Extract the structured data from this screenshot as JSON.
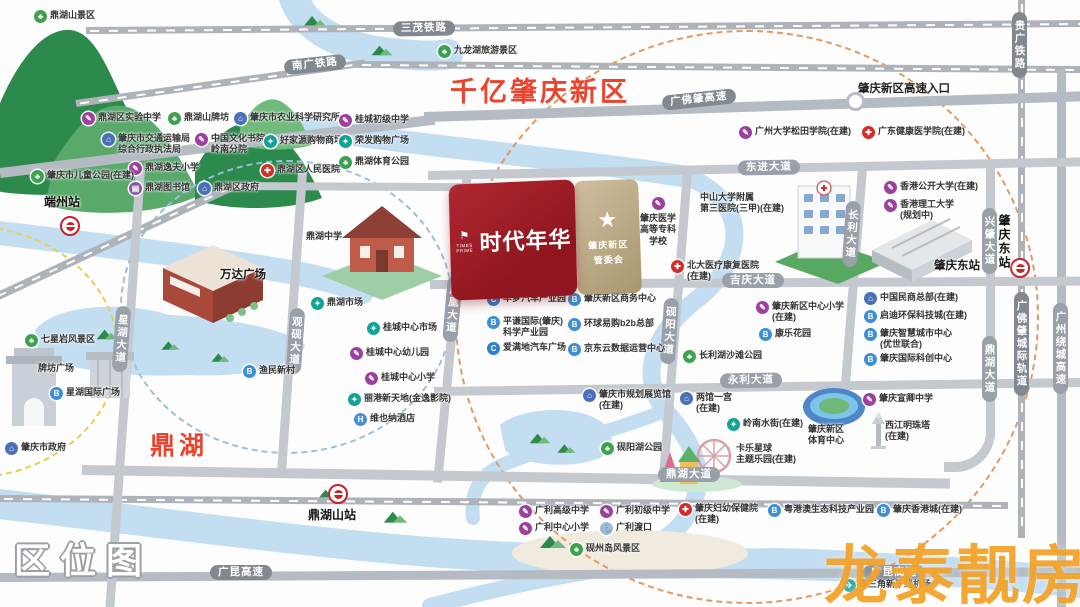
{
  "texts": {
    "qianyi": "千亿肇庆新区",
    "dinghu_area": "鼎湖",
    "quweitu": "区位图",
    "entrance": "肇庆新区高速入口"
  },
  "property": {
    "name": "时代年华",
    "logo_en": "TIMES PRIME",
    "star_icon": "★",
    "committee_lines": [
      "肇庆新区",
      "管委会"
    ]
  },
  "watermark": {
    "text": "龙泰靓房"
  },
  "map": {
    "icon_glyphs": {
      "park": "♣",
      "school": "✎",
      "gov": "⌂",
      "shop": "✦",
      "hospital": "✚",
      "library": "▤",
      "business": "B",
      "hotel": "H",
      "car": "C",
      "ferry": "⚓",
      "airport": "✈"
    },
    "roads": [
      {
        "id": "sanmao-railway",
        "kind": "rail",
        "vert": false,
        "x": 86,
        "y": 27,
        "len": 1000,
        "thick": 7,
        "angle": -0.4
      },
      {
        "id": "nanguang-railway-west",
        "kind": "rail",
        "vert": false,
        "x": 76,
        "y": 100,
        "len": 292,
        "thick": 7,
        "angle": -8
      },
      {
        "id": "nanguang-railway",
        "kind": "rail",
        "vert": false,
        "x": 358,
        "y": 61,
        "len": 724,
        "thick": 7,
        "angle": 0.4
      },
      {
        "id": "duanzhou-railway",
        "kind": "rail",
        "vert": false,
        "x": -6,
        "y": 294,
        "len": 262,
        "thick": 8,
        "angle": -25
      },
      {
        "id": "bottom-railway",
        "kind": "rail",
        "vert": false,
        "x": 0,
        "y": 495,
        "len": 1008,
        "thick": 7,
        "angle": 0.4
      },
      {
        "id": "gfz-intercity-railway",
        "kind": "rail",
        "vert": true,
        "x": 1018,
        "y": 0,
        "len": 538,
        "thick": 7,
        "angle": 0
      },
      {
        "id": "gfz-expressway-west",
        "kind": "hwy",
        "vert": false,
        "x": 0,
        "y": 168,
        "len": 438,
        "thick": 10,
        "angle": -7
      },
      {
        "id": "gfz-expressway",
        "kind": "hwy",
        "vert": false,
        "x": 424,
        "y": 112,
        "len": 660,
        "thick": 10,
        "angle": -1.8
      },
      {
        "id": "guangkun-expressway",
        "kind": "hwy",
        "vert": false,
        "x": 0,
        "y": 573,
        "len": 1085,
        "thick": 9,
        "angle": -0.3
      },
      {
        "id": "gz-ring-expressway",
        "kind": "hwy",
        "vert": true,
        "x": 1057,
        "y": 70,
        "len": 537,
        "thick": 9,
        "angle": 0
      },
      {
        "id": "dongjin-avenue",
        "kind": "road",
        "vert": false,
        "x": 428,
        "y": 171,
        "len": 656,
        "thick": 9,
        "angle": -1.2
      },
      {
        "id": "jiqing-avenue",
        "kind": "road",
        "vert": false,
        "x": 430,
        "y": 280,
        "len": 652,
        "thick": 9,
        "angle": -0.3
      },
      {
        "id": "yongli-avenue",
        "kind": "road",
        "vert": false,
        "x": 434,
        "y": 387,
        "len": 650,
        "thick": 9,
        "angle": -0.8
      },
      {
        "id": "dinghu-avenue",
        "kind": "road",
        "vert": false,
        "x": 82,
        "y": 465,
        "len": 868,
        "thick": 10,
        "angle": 0.9
      },
      {
        "id": "dinghu-avenue-north",
        "kind": "road",
        "vert": true,
        "x": 986,
        "y": 166,
        "len": 272,
        "thick": 9,
        "angle": 0
      },
      {
        "id": "xinghu-avenue",
        "kind": "road",
        "vert": true,
        "x": 136,
        "y": 170,
        "len": 445,
        "thick": 9,
        "angle": 4
      },
      {
        "id": "guanyan-avenue",
        "kind": "road",
        "vert": true,
        "x": 298,
        "y": 172,
        "len": 305,
        "thick": 9,
        "angle": 4
      },
      {
        "id": "fenghuang-avenue",
        "kind": "road",
        "vert": true,
        "x": 463,
        "y": 172,
        "len": 312,
        "thick": 9,
        "angle": 5.5
      },
      {
        "id": "yanyang-avenue",
        "kind": "road",
        "vert": true,
        "x": 683,
        "y": 172,
        "len": 312,
        "thick": 9,
        "angle": 4.5
      },
      {
        "id": "changli-avenue",
        "kind": "road",
        "vert": true,
        "x": 858,
        "y": 168,
        "len": 220,
        "thick": 9,
        "angle": 4.5
      },
      {
        "id": "mid-connector-road",
        "kind": "road",
        "vert": false,
        "x": 228,
        "y": 182,
        "len": 248,
        "thick": 8,
        "angle": 0.3
      }
    ],
    "road_labels": [
      {
        "id": "label-sanmao",
        "text": "三茂铁路",
        "x": 393,
        "y": 21,
        "dark": true,
        "vert": false,
        "angle": -1
      },
      {
        "id": "label-nanguang",
        "text": "南广铁路",
        "x": 284,
        "y": 57,
        "dark": true,
        "vert": false,
        "angle": -6
      },
      {
        "id": "label-guiguang",
        "text": "贵广铁路",
        "x": 1012,
        "y": 12,
        "dark": true,
        "vert": true,
        "angle": 0
      },
      {
        "id": "label-gfz-expressway",
        "text": "广佛肇高速",
        "x": 662,
        "y": 92,
        "dark": true,
        "vert": false,
        "angle": -6
      },
      {
        "id": "label-dongjin",
        "text": "东进大道",
        "x": 738,
        "y": 160,
        "dark": false,
        "vert": false,
        "angle": -1
      },
      {
        "id": "label-jiqing",
        "text": "吉庆大道",
        "x": 722,
        "y": 273,
        "dark": false,
        "vert": false,
        "angle": 0
      },
      {
        "id": "label-yongli",
        "text": "永利大道",
        "x": 720,
        "y": 373,
        "dark": false,
        "vert": false,
        "angle": -1
      },
      {
        "id": "label-dinghu",
        "text": "鼎湖大道",
        "x": 658,
        "y": 467,
        "dark": false,
        "vert": false,
        "angle": 0
      },
      {
        "id": "label-dinghu-north",
        "text": "鼎湖大道",
        "x": 982,
        "y": 336,
        "dark": false,
        "vert": true,
        "angle": 0
      },
      {
        "id": "label-xingzhao",
        "text": "兴肇大道",
        "x": 982,
        "y": 208,
        "dark": false,
        "vert": true,
        "angle": 0
      },
      {
        "id": "label-intercity",
        "text": "广佛肇城际轨道",
        "x": 1014,
        "y": 292,
        "dark": true,
        "vert": true,
        "angle": 0
      },
      {
        "id": "label-gzring",
        "text": "广州绕城高速",
        "x": 1053,
        "y": 303,
        "dark": false,
        "vert": true,
        "angle": 0
      },
      {
        "id": "label-xinghu",
        "text": "星湖大道",
        "x": 114,
        "y": 306,
        "dark": false,
        "vert": true,
        "angle": 4
      },
      {
        "id": "label-guanyan",
        "text": "观砚大道",
        "x": 288,
        "y": 308,
        "dark": false,
        "vert": true,
        "angle": 4
      },
      {
        "id": "label-fenghuang",
        "text": "凤凰大道",
        "x": 445,
        "y": 276,
        "dark": false,
        "vert": true,
        "angle": 5
      },
      {
        "id": "label-yanyang",
        "text": "砚阳大道",
        "x": 662,
        "y": 298,
        "dark": false,
        "vert": true,
        "angle": 4
      },
      {
        "id": "label-changli",
        "text": "长利大道",
        "x": 844,
        "y": 201,
        "dark": false,
        "vert": true,
        "angle": 4
      },
      {
        "id": "label-guangkun-west",
        "text": "广昆高速",
        "x": 210,
        "y": 565,
        "dark": true,
        "vert": false,
        "angle": 0
      },
      {
        "id": "label-guangkun-east",
        "text": "广昆高速",
        "x": 863,
        "y": 565,
        "dark": true,
        "vert": false,
        "angle": 0
      }
    ],
    "stations": [
      {
        "id": "duanzhou-station",
        "label": "端州站",
        "icon": [
          60,
          216
        ],
        "lx": 44,
        "ly": 193,
        "vert": false
      },
      {
        "id": "dinghushan-station",
        "label": "鼎湖山站",
        "icon": [
          328,
          484
        ],
        "lx": 308,
        "ly": 506,
        "vert": false
      },
      {
        "id": "zhaoqingdong-station",
        "label": "肇庆东站",
        "icon": [
          1010,
          258
        ],
        "lx": 996,
        "ly": 214,
        "vert": true
      }
    ],
    "pois": [
      {
        "type": "park",
        "x": 34,
        "y": 10,
        "lines": [
          "鼎湖山景区"
        ]
      },
      {
        "type": "park",
        "x": 438,
        "y": 45,
        "lines": [
          "九龙湖旅游景区"
        ]
      },
      {
        "type": "school",
        "x": 82,
        "y": 112,
        "lines": [
          "鼎湖区实验中学"
        ]
      },
      {
        "type": "park",
        "x": 168,
        "y": 112,
        "lines": [
          "鼎湖山牌坊"
        ]
      },
      {
        "type": "gov",
        "x": 234,
        "y": 112,
        "lines": [
          "肇庆市农业科学研究所"
        ]
      },
      {
        "type": "school",
        "x": 339,
        "y": 114,
        "lines": [
          "桂城初级中学"
        ]
      },
      {
        "type": "gov",
        "x": 102,
        "y": 133,
        "lines": [
          "肇庆市交通运输局",
          "综合行政执法局"
        ]
      },
      {
        "type": "school",
        "x": 195,
        "y": 133,
        "lines": [
          "中国文化书院",
          "岭南分院"
        ]
      },
      {
        "type": "shop",
        "x": 264,
        "y": 135,
        "lines": [
          "好家源购物商场"
        ]
      },
      {
        "type": "shop",
        "x": 339,
        "y": 135,
        "lines": [
          "荣发购物广场"
        ]
      },
      {
        "type": "park",
        "x": 339,
        "y": 156,
        "lines": [
          "鼎湖体育公园"
        ]
      },
      {
        "type": "school",
        "x": 129,
        "y": 162,
        "lines": [
          "鼎湖逸夫小学"
        ]
      },
      {
        "type": "park",
        "x": 31,
        "y": 170,
        "lines": [
          "肇庆市儿童公园(在建)"
        ]
      },
      {
        "type": "library",
        "x": 129,
        "y": 182,
        "lines": [
          "鼎湖图书馆"
        ]
      },
      {
        "type": "gov",
        "x": 198,
        "y": 182,
        "lines": [
          "鼎湖区政府"
        ]
      },
      {
        "type": "hospital",
        "x": 261,
        "y": 164,
        "lines": [
          "鼎湖区人民医院"
        ]
      },
      {
        "type": "school",
        "x": 739,
        "y": 126,
        "lines": [
          "广州大学松田学院(在建)"
        ]
      },
      {
        "type": "hospital",
        "x": 862,
        "y": 126,
        "lines": [
          "广东健康医学院(在建)"
        ]
      },
      {
        "type": "school",
        "x": 884,
        "y": 181,
        "lines": [
          "香港公开大学(在建)"
        ]
      },
      {
        "type": "school",
        "x": 884,
        "y": 199,
        "lines": [
          "香港理工大学",
          "(规划中)"
        ]
      },
      {
        "type": "label",
        "x": 700,
        "y": 192,
        "lines": [
          "中山大学附属",
          "第三医院(三甲)(在建)"
        ]
      },
      {
        "type": "hospital",
        "x": 671,
        "y": 260,
        "lines": [
          "北大医疗康复医院",
          "(在建)"
        ]
      },
      {
        "type": "school",
        "x": 756,
        "y": 301,
        "lines": [
          "肇庆新区中心小学",
          "(在建)"
        ]
      },
      {
        "type": "business",
        "x": 759,
        "y": 328,
        "lines": [
          "康乐花园"
        ]
      },
      {
        "type": "label",
        "x": 306,
        "y": 231,
        "lines": [
          "鼎湖中学"
        ]
      },
      {
        "type": "label",
        "x": 220,
        "y": 268,
        "lines": [
          "万达广场"
        ],
        "big": true
      },
      {
        "type": "shop",
        "x": 311,
        "y": 297,
        "lines": [
          "鼎湖市场"
        ]
      },
      {
        "type": "shop",
        "x": 367,
        "y": 322,
        "lines": [
          "桂城中心市场"
        ]
      },
      {
        "type": "school",
        "x": 350,
        "y": 347,
        "lines": [
          "桂城中心幼儿园"
        ]
      },
      {
        "type": "school",
        "x": 365,
        "y": 372,
        "lines": [
          "桂城中心小学"
        ]
      },
      {
        "type": "shop",
        "x": 348,
        "y": 393,
        "lines": [
          "丽港新天地(金逸影院)"
        ]
      },
      {
        "type": "hotel",
        "x": 354,
        "y": 413,
        "lines": [
          "维也纳酒店"
        ]
      },
      {
        "type": "business",
        "x": 243,
        "y": 365,
        "lines": [
          "渔民新村"
        ]
      },
      {
        "type": "park",
        "x": 25,
        "y": 334,
        "lines": [
          "七星岩风景区"
        ]
      },
      {
        "type": "label",
        "x": 38,
        "y": 363,
        "lines": [
          "牌坊广场"
        ]
      },
      {
        "type": "business",
        "x": 50,
        "y": 387,
        "lines": [
          "星湖国际广场"
        ]
      },
      {
        "type": "gov",
        "x": 5,
        "y": 442,
        "lines": [
          "肇庆市政府"
        ]
      },
      {
        "type": "school",
        "x": 640,
        "y": 197,
        "lines": [
          "肇庆医学",
          "高等专科",
          "学校"
        ],
        "stack": true
      },
      {
        "type": "car",
        "x": 487,
        "y": 293,
        "lines": [
          "华梦汽车产业园"
        ]
      },
      {
        "type": "business",
        "x": 568,
        "y": 293,
        "lines": [
          "肇庆新区商务中心"
        ]
      },
      {
        "type": "business",
        "x": 487,
        "y": 316,
        "lines": [
          "平谦国际(肇庆)",
          "科学产业园"
        ]
      },
      {
        "type": "business",
        "x": 568,
        "y": 318,
        "lines": [
          "环球易购b2b总部"
        ]
      },
      {
        "type": "car",
        "x": 487,
        "y": 342,
        "lines": [
          "爱满地汽车广场"
        ]
      },
      {
        "type": "business",
        "x": 568,
        "y": 343,
        "lines": [
          "京东云数据运营中心"
        ]
      },
      {
        "type": "park",
        "x": 683,
        "y": 350,
        "lines": [
          "长利湖沙滩公园"
        ]
      },
      {
        "type": "gov",
        "x": 583,
        "y": 389,
        "lines": [
          "肇庆市规划展览馆",
          "(在建)"
        ]
      },
      {
        "type": "park",
        "x": 601,
        "y": 442,
        "lines": [
          "砚阳湖公园"
        ]
      },
      {
        "type": "gov",
        "x": 680,
        "y": 392,
        "lines": [
          "两馆一宫",
          "(在建)"
        ]
      },
      {
        "type": "shop",
        "x": 727,
        "y": 418,
        "lines": [
          "岭南水街(在建)"
        ]
      },
      {
        "type": "label",
        "x": 736,
        "y": 443,
        "lines": [
          "卡乐星球",
          "主题乐园(在建)"
        ]
      },
      {
        "type": "label",
        "x": 808,
        "y": 424,
        "lines": [
          "肇庆新区",
          "体育中心"
        ]
      },
      {
        "type": "school",
        "x": 863,
        "y": 393,
        "lines": [
          "肇庆宣卿中学"
        ]
      },
      {
        "type": "label",
        "x": 885,
        "y": 420,
        "lines": [
          "西江明珠塔",
          "(在建)"
        ]
      },
      {
        "type": "gov",
        "x": 864,
        "y": 292,
        "lines": [
          "中国民商总部(在建)"
        ]
      },
      {
        "type": "business",
        "x": 864,
        "y": 310,
        "lines": [
          "启迪环保科技城(在建)"
        ]
      },
      {
        "type": "business",
        "x": 864,
        "y": 328,
        "lines": [
          "肇庆智慧城市中心",
          "(优世联合)"
        ]
      },
      {
        "type": "business",
        "x": 864,
        "y": 353,
        "lines": [
          "肇庆国际科创中心"
        ]
      },
      {
        "type": "label",
        "x": 934,
        "y": 259,
        "lines": [
          "肇庆东站"
        ],
        "big": true
      },
      {
        "type": "school",
        "x": 519,
        "y": 505,
        "lines": [
          "广利高级中学"
        ]
      },
      {
        "type": "school",
        "x": 600,
        "y": 505,
        "lines": [
          "广利初级中学"
        ]
      },
      {
        "type": "school",
        "x": 519,
        "y": 522,
        "lines": [
          "广利中心小学"
        ]
      },
      {
        "type": "ferry",
        "x": 600,
        "y": 522,
        "lines": [
          "广利渡口"
        ]
      },
      {
        "type": "park",
        "x": 570,
        "y": 543,
        "lines": [
          "砚州岛风景区"
        ]
      },
      {
        "type": "hospital",
        "x": 679,
        "y": 503,
        "lines": [
          "肇庆妇幼保健院",
          "(在建)"
        ]
      },
      {
        "type": "business",
        "x": 768,
        "y": 504,
        "lines": [
          "粤港澳生态科技产业园"
        ]
      },
      {
        "type": "business",
        "x": 877,
        "y": 504,
        "lines": [
          "肇庆香港城(在建)"
        ]
      },
      {
        "type": "airport",
        "x": 843,
        "y": 579,
        "lines": [
          "珠三角新干线机场"
        ]
      }
    ]
  }
}
